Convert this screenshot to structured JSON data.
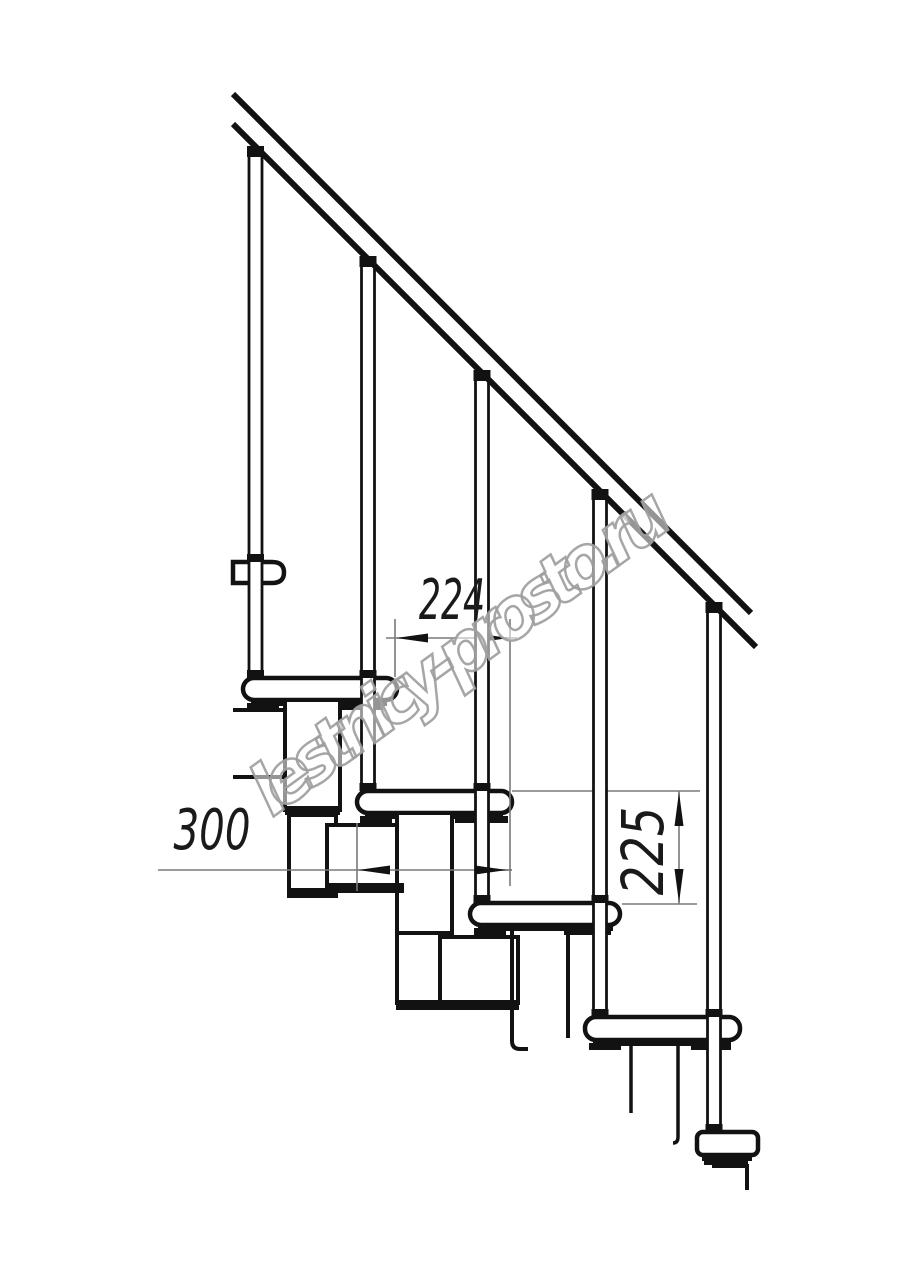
{
  "drawing": {
    "watermark": "lestnicy-prosto.ru",
    "dimensions": {
      "run": {
        "value": "224",
        "orientation": "horizontal"
      },
      "depth": {
        "value": "300",
        "orientation": "horizontal"
      },
      "rise": {
        "value": "225",
        "orientation": "vertical"
      }
    },
    "colors": {
      "background": "#ffffff",
      "linework": "#121212",
      "dimension_lines": "#7a7a7a",
      "watermark_outline": "#a3a3a3"
    }
  }
}
